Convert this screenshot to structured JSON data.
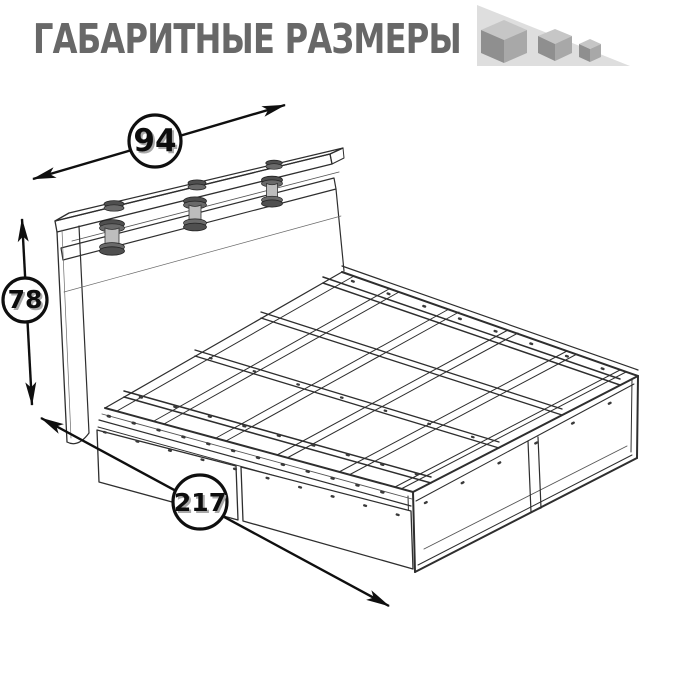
{
  "header": {
    "title": "ГАБАРИТНЫЕ РАЗМЕРЫ",
    "title_color": "#686868",
    "logo": {
      "name": "three-shrinking-cubes-logo",
      "triangle_color": "#dedede",
      "cube_top_color": "#c6c6c6",
      "cube_left_color": "#8f8f8f",
      "cube_right_color": "#a8a8a8"
    }
  },
  "diagram": {
    "subject": "wireframe technical drawing of a bed with headboard shelf on spool posts, slatted base, open foot storage box and two under-bed drawers",
    "line_color": "#2e2e2e",
    "annotation_color": "#0f0f0f",
    "dimensions": {
      "width": {
        "value": "94",
        "role": "headboard width, arrow along top shelf"
      },
      "height": {
        "value": "78",
        "role": "headboard height, vertical arrow at left"
      },
      "length": {
        "value": "217",
        "role": "bed length, arrow along front lower edge"
      }
    }
  }
}
